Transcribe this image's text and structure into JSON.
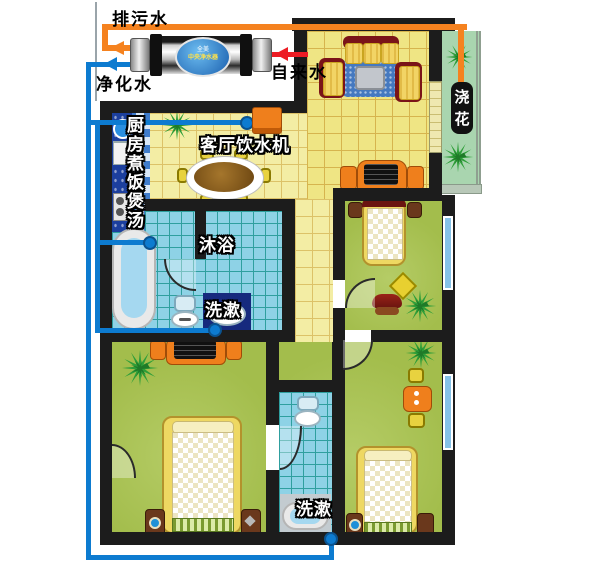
{
  "system": {
    "drain_label": "排污水",
    "purified_label": "净化水",
    "tap_label": "自来水",
    "filter": {
      "brand": "全美",
      "model": "中央净水器"
    },
    "outlets": {
      "kitchen": "厨房煮饭煲汤",
      "living_dispenser": "客厅饮水机",
      "shower": "沐浴",
      "wash_main": "洗漱",
      "wash_secondary": "洗漱",
      "balcony_flowers": "浇花"
    },
    "colors": {
      "drain_pipe": "#f5821f",
      "tap_pipe": "#ed1c24",
      "purified_pipe": "#0d7bd0",
      "wall": "#1c1c1c",
      "dispenser": "#ef7f1c"
    }
  }
}
